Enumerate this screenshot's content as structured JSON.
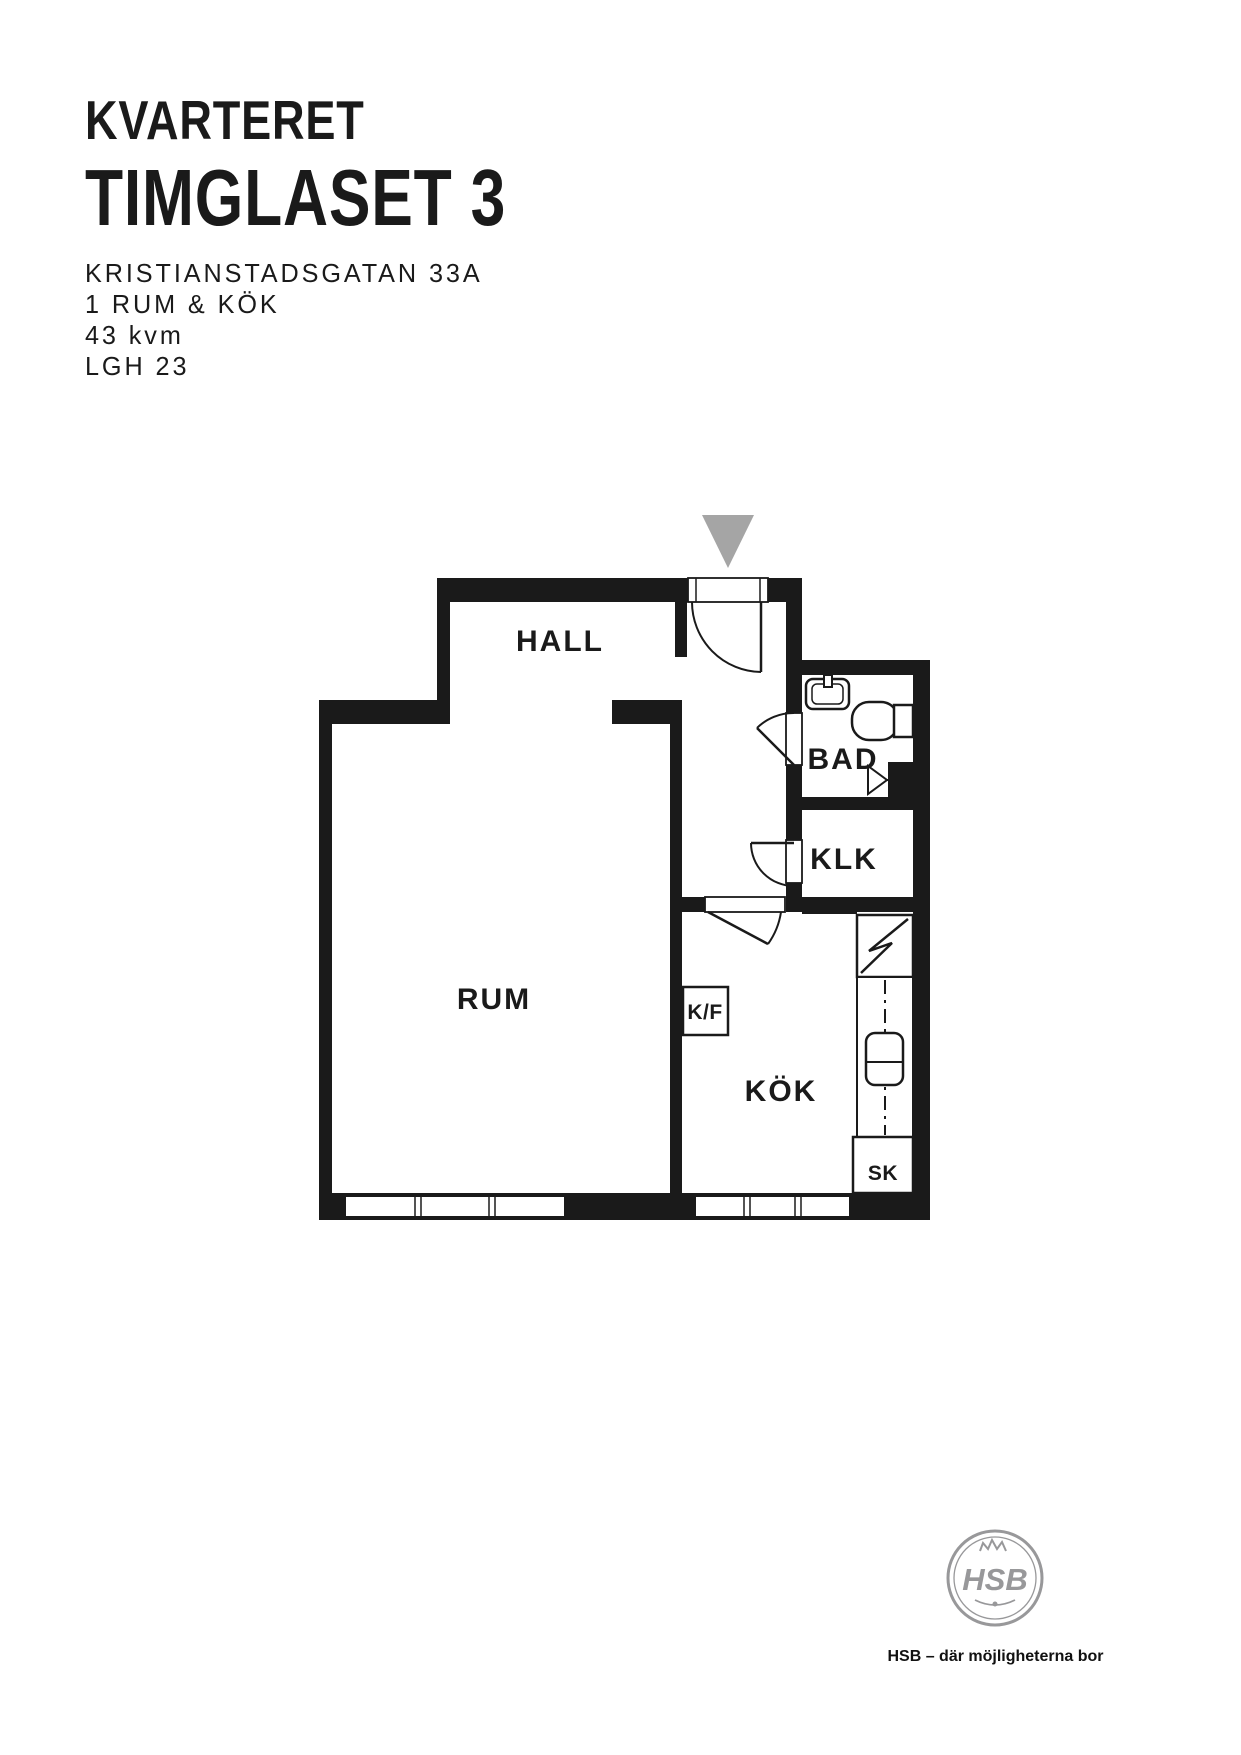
{
  "header": {
    "line1": "KVARTERET",
    "line2": "TIMGLASET 3",
    "address": "KRISTIANSTADSGATAN 33A",
    "type": "1 RUM & KÖK",
    "area": "43 kvm",
    "apartment": "LGH 23"
  },
  "plan": {
    "wall_color": "#1a1a1a",
    "entrance_arrow_color": "#a5a5a5",
    "rooms": {
      "hall": "HALL",
      "bad": "BAD",
      "klk": "KLK",
      "rum": "RUM",
      "kok": "KÖK"
    },
    "fixtures": {
      "fridge_freezer": "K/F",
      "cleaning_closet": "SK"
    }
  },
  "footer": {
    "logo_text": "HSB",
    "tagline": "HSB – där möjligheterna bor",
    "logo_color": "#98989a"
  }
}
